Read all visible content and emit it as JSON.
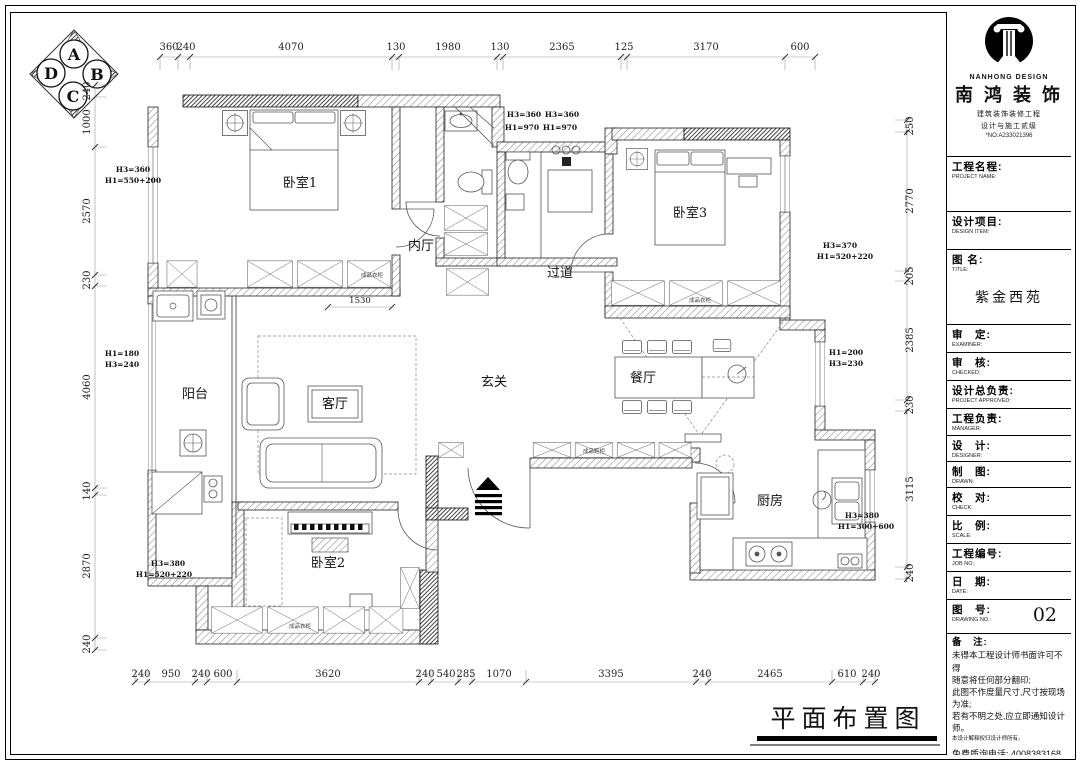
{
  "compass": {
    "n": "A",
    "e": "B",
    "s": "C",
    "w": "D"
  },
  "dims": {
    "top": [
      "360",
      "240",
      "4070",
      "130",
      "1980",
      "130",
      "2365",
      "125",
      "3170",
      "600"
    ],
    "bottom": [
      "240",
      "950",
      "240",
      "600",
      "3620",
      "240",
      "540",
      "285",
      "1070",
      "3395",
      "240",
      "2465",
      "610",
      "240"
    ],
    "left": [
      "240",
      "1000",
      "2570",
      "230",
      "4060",
      "140",
      "2870",
      "240"
    ],
    "right": [
      "250",
      "2770",
      "205",
      "2385",
      "230",
      "3115",
      "240"
    ],
    "inner": "1530"
  },
  "rooms": {
    "bedroom1": "卧室1",
    "bedroom2": "卧室2",
    "bedroom3": "卧室3",
    "inner_hall": "内厅",
    "corridor": "过道",
    "entry": "玄关",
    "living": "客厅",
    "dining": "餐厅",
    "balcony": "阳台",
    "kitchen": "厨房"
  },
  "labels": {
    "wardrobe": "成品衣柜",
    "shoe": "成品鞋柜"
  },
  "h_annotations": {
    "left_top": [
      "H3=360",
      "H1=550+200"
    ],
    "left_mid": [
      "H1=180",
      "H3=240"
    ],
    "left_bottom": [
      "H3=380",
      "H1=520+220"
    ],
    "top_a": [
      "H3=360",
      "H1=970"
    ],
    "top_b": [
      "H3=360",
      "H1=970"
    ],
    "right_top": [
      "H3=370",
      "H1=520+220"
    ],
    "right_mid": [
      "H1=200",
      "H3=230"
    ],
    "right_bottom": [
      "H3=380",
      "H1=300+600"
    ]
  },
  "plan_title": "平面布置图",
  "title_block": {
    "brand": {
      "en": "NANHONG DESIGN",
      "cn": "南 鸿 装 饰",
      "sub1": "建筑装饰装修工程",
      "sub2": "设计与施工贰级",
      "no": "*NO:A233021396"
    },
    "rows": [
      {
        "cn": "工程名程:",
        "en": "PROJECT NAME:"
      },
      {
        "cn": "设计项目:",
        "en": "DESIGN ITEM:"
      },
      {
        "cn": "图 名:",
        "en": "TITLE:"
      },
      {
        "cn": "审　定:",
        "en": "EXAMINER:"
      },
      {
        "cn": "审　核:",
        "en": "CHECKED:"
      },
      {
        "cn": "设计总负责:",
        "en": "PROJECT APPROVED:"
      },
      {
        "cn": "工程负责:",
        "en": "MANAGER:"
      },
      {
        "cn": "设　计:",
        "en": "DESIGNER:"
      },
      {
        "cn": "制　图:",
        "en": "DRAWN:"
      },
      {
        "cn": "校　对:",
        "en": "CHECK:"
      },
      {
        "cn": "比　例:",
        "en": "SCALE:"
      },
      {
        "cn": "工程编号:",
        "en": "JOB NO.:"
      },
      {
        "cn": "日　期:",
        "en": "DATE:"
      },
      {
        "cn": "图　号:",
        "en": "DRAWING NO.:"
      }
    ],
    "project_title": "紫金西苑",
    "drawing_no": "02",
    "notes_title": "备　注:",
    "notes": [
      "未得本工程设计师书面许可不得",
      "随意将任何部分翻印;",
      "此图不作度量尺寸,尺寸按现场",
      "为准;",
      "若有不明之处,应立即通知设计",
      "师。"
    ],
    "notes_small": "本设计解释权归设计师所有。",
    "phone": "免费质询电话: 4008383168"
  }
}
